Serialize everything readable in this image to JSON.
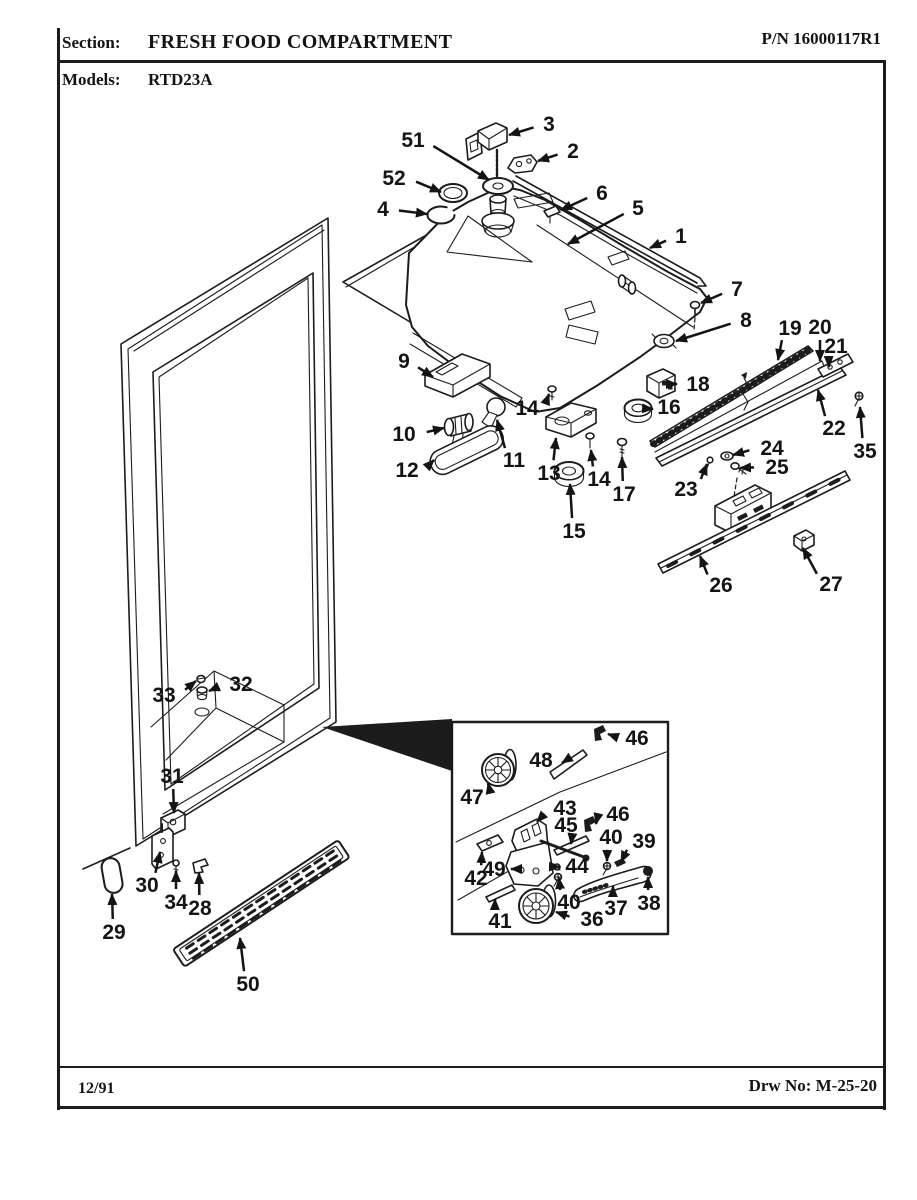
{
  "header": {
    "section_label": "Section:",
    "section_title": "FRESH FOOD COMPARTMENT",
    "part_number": "P/N 16000117R1",
    "models_label": "Models:",
    "models_value": "RTD23A"
  },
  "footer": {
    "issue_date": "12/91",
    "drawing_number": "Drw No: M-25-20"
  },
  "colors": {
    "ink": "#1c1c1c",
    "paper": "#ffffff"
  },
  "diagram": {
    "callouts": [
      {
        "n": "1",
        "lx": 681,
        "ly": 236,
        "tx": 650,
        "ty": 248
      },
      {
        "n": "2",
        "lx": 573,
        "ly": 151,
        "tx": 538,
        "ty": 161
      },
      {
        "n": "3",
        "lx": 549,
        "ly": 124,
        "tx": 509,
        "ty": 135
      },
      {
        "n": "4",
        "lx": 383,
        "ly": 209,
        "tx": 427,
        "ty": 214
      },
      {
        "n": "5",
        "lx": 638,
        "ly": 208,
        "tx": 568,
        "ty": 244
      },
      {
        "n": "6",
        "lx": 602,
        "ly": 193,
        "tx": 561,
        "ty": 210
      },
      {
        "n": "7",
        "lx": 737,
        "ly": 289,
        "tx": 701,
        "ty": 303
      },
      {
        "n": "8",
        "lx": 746,
        "ly": 320,
        "tx": 676,
        "ty": 341
      },
      {
        "n": "9",
        "lx": 404,
        "ly": 361,
        "tx": 433,
        "ty": 377
      },
      {
        "n": "10",
        "lx": 404,
        "ly": 434,
        "tx": 444,
        "ty": 428
      },
      {
        "n": "11",
        "lx": 514,
        "ly": 460,
        "tx": 497,
        "ty": 420
      },
      {
        "n": "12",
        "lx": 407,
        "ly": 470,
        "tx": 434,
        "ty": 460
      },
      {
        "n": "13",
        "lx": 549,
        "ly": 473,
        "tx": 556,
        "ty": 438
      },
      {
        "n": "14",
        "lx": 527,
        "ly": 408,
        "tx": 549,
        "ty": 394
      },
      {
        "n": "14",
        "lx": 599,
        "ly": 479,
        "tx": 591,
        "ty": 450
      },
      {
        "n": "15",
        "lx": 574,
        "ly": 531,
        "tx": 570,
        "ty": 484
      },
      {
        "n": "16",
        "lx": 669,
        "ly": 407,
        "tx": 653,
        "ty": 409
      },
      {
        "n": "17",
        "lx": 624,
        "ly": 494,
        "tx": 622,
        "ty": 457
      },
      {
        "n": "18",
        "lx": 698,
        "ly": 384,
        "tx": 677,
        "ty": 384
      },
      {
        "n": "19",
        "lx": 790,
        "ly": 328,
        "tx": 778,
        "ty": 360
      },
      {
        "n": "20",
        "lx": 820,
        "ly": 327,
        "tx": 820,
        "ty": 361
      },
      {
        "n": "21",
        "lx": 836,
        "ly": 346,
        "tx": 829,
        "ty": 367
      },
      {
        "n": "22",
        "lx": 834,
        "ly": 428,
        "tx": 818,
        "ty": 390
      },
      {
        "n": "23",
        "lx": 686,
        "ly": 489,
        "tx": 707,
        "ty": 464
      },
      {
        "n": "24",
        "lx": 772,
        "ly": 448,
        "tx": 733,
        "ty": 455
      },
      {
        "n": "25",
        "lx": 777,
        "ly": 467,
        "tx": 740,
        "ty": 468
      },
      {
        "n": "26",
        "lx": 721,
        "ly": 585,
        "tx": 700,
        "ty": 556
      },
      {
        "n": "27",
        "lx": 831,
        "ly": 584,
        "tx": 803,
        "ty": 548
      },
      {
        "n": "28",
        "lx": 200,
        "ly": 908,
        "tx": 199,
        "ty": 873
      },
      {
        "n": "29",
        "lx": 114,
        "ly": 932,
        "tx": 112,
        "ty": 894
      },
      {
        "n": "30",
        "lx": 147,
        "ly": 885,
        "tx": 160,
        "ty": 852
      },
      {
        "n": "31",
        "lx": 172,
        "ly": 776,
        "tx": 174,
        "ty": 813
      },
      {
        "n": "32",
        "lx": 241,
        "ly": 684,
        "tx": 209,
        "ty": 691
      },
      {
        "n": "33",
        "lx": 164,
        "ly": 695,
        "tx": 196,
        "ty": 681
      },
      {
        "n": "34",
        "lx": 176,
        "ly": 902,
        "tx": 176,
        "ty": 871
      },
      {
        "n": "35",
        "lx": 865,
        "ly": 451,
        "tx": 860,
        "ty": 407
      },
      {
        "n": "36",
        "lx": 592,
        "ly": 919,
        "tx": 556,
        "ty": 912
      },
      {
        "n": "37",
        "lx": 616,
        "ly": 908,
        "tx": 613,
        "ty": 886
      },
      {
        "n": "38",
        "lx": 649,
        "ly": 903,
        "tx": 648,
        "ty": 877
      },
      {
        "n": "39",
        "lx": 644,
        "ly": 841,
        "tx": 621,
        "ty": 862
      },
      {
        "n": "40",
        "lx": 611,
        "ly": 837,
        "tx": 607,
        "ty": 861
      },
      {
        "n": "40",
        "lx": 569,
        "ly": 902,
        "tx": 559,
        "ty": 878
      },
      {
        "n": "41",
        "lx": 500,
        "ly": 921,
        "tx": 495,
        "ty": 899
      },
      {
        "n": "42",
        "lx": 476,
        "ly": 878,
        "tx": 482,
        "ty": 852
      },
      {
        "n": "43",
        "lx": 565,
        "ly": 808,
        "tx": 537,
        "ty": 822
      },
      {
        "n": "44",
        "lx": 577,
        "ly": 866,
        "tx": 560,
        "ty": 867
      },
      {
        "n": "45",
        "lx": 566,
        "ly": 825,
        "tx": 571,
        "ty": 844
      },
      {
        "n": "46",
        "lx": 637,
        "ly": 738,
        "tx": 608,
        "ty": 734
      },
      {
        "n": "46",
        "lx": 618,
        "ly": 814,
        "tx": 596,
        "ty": 824
      },
      {
        "n": "47",
        "lx": 472,
        "ly": 797,
        "tx": 488,
        "ty": 783
      },
      {
        "n": "48",
        "lx": 541,
        "ly": 760,
        "tx": 562,
        "ty": 763
      },
      {
        "n": "49",
        "lx": 494,
        "ly": 869,
        "tx": 511,
        "ty": 869
      },
      {
        "n": "50",
        "lx": 248,
        "ly": 984,
        "tx": 240,
        "ty": 938
      },
      {
        "n": "51",
        "lx": 413,
        "ly": 140,
        "tx": 489,
        "ty": 180
      },
      {
        "n": "52",
        "lx": 394,
        "ly": 178,
        "tx": 441,
        "ty": 192
      }
    ]
  }
}
